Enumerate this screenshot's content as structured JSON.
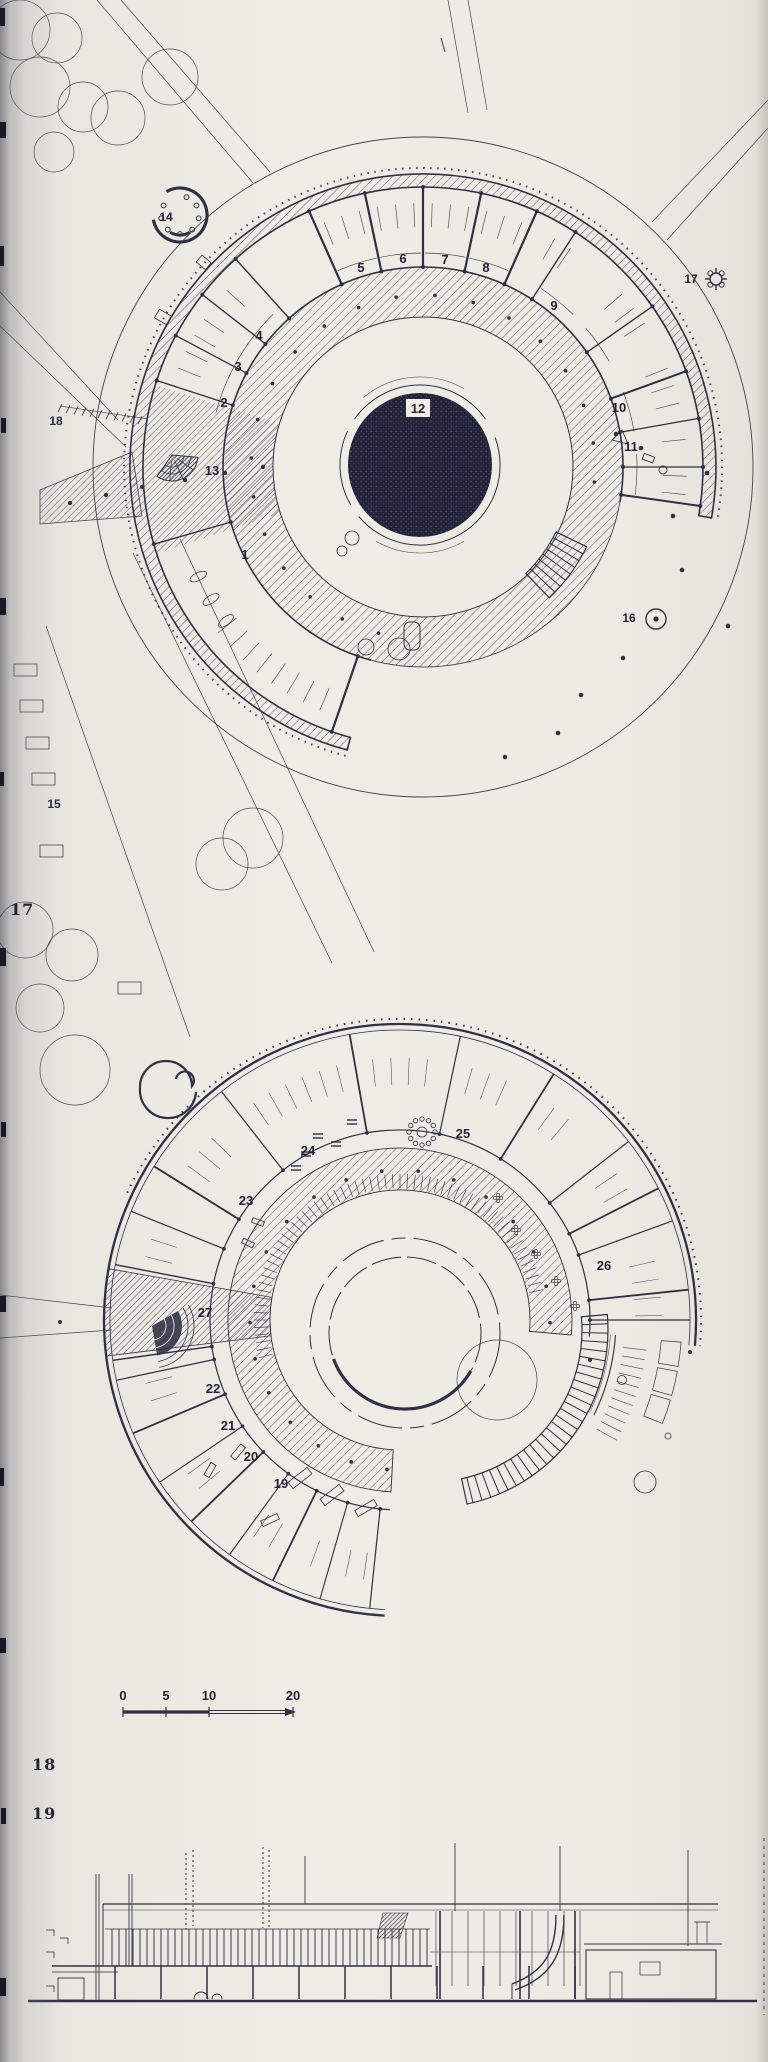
{
  "page": {
    "kind": "scanned architectural drawing page",
    "paper_color": "#ece9e2",
    "ink_color": "#2f3046",
    "pond_fill": "#23233a"
  },
  "figure_margin_numbers": [
    {
      "label": "17",
      "x": 10,
      "y": 900
    },
    {
      "label": "18",
      "x": 32,
      "y": 1755
    },
    {
      "label": "19",
      "x": 32,
      "y": 1804
    }
  ],
  "plan_upper": {
    "description": "circular building ground-floor site plan",
    "room_labels": [
      {
        "n": "1",
        "x": 245,
        "y": 559
      },
      {
        "n": "2",
        "x": 224,
        "y": 407
      },
      {
        "n": "3",
        "x": 238,
        "y": 371
      },
      {
        "n": "4",
        "x": 259,
        "y": 340
      },
      {
        "n": "5",
        "x": 361,
        "y": 272
      },
      {
        "n": "6",
        "x": 403,
        "y": 263
      },
      {
        "n": "7",
        "x": 445,
        "y": 264
      },
      {
        "n": "8",
        "x": 486,
        "y": 272
      },
      {
        "n": "9",
        "x": 554,
        "y": 310
      },
      {
        "n": "10",
        "x": 619,
        "y": 412
      },
      {
        "n": "11",
        "x": 631,
        "y": 451
      },
      {
        "n": "13",
        "x": 212,
        "y": 475
      }
    ],
    "pond_label": {
      "n": "12",
      "x": 418,
      "y": 413
    },
    "site_labels": [
      {
        "n": "14",
        "x": 166,
        "y": 221
      },
      {
        "n": "15",
        "x": 54,
        "y": 808
      },
      {
        "n": "16",
        "x": 629,
        "y": 622
      },
      {
        "n": "17",
        "x": 691,
        "y": 283
      },
      {
        "n": "18",
        "x": 56,
        "y": 425
      }
    ]
  },
  "plan_lower": {
    "description": "circular building floor plan, C-shaped level",
    "room_labels": [
      {
        "n": "19",
        "x": 281,
        "y": 1488
      },
      {
        "n": "20",
        "x": 251,
        "y": 1461
      },
      {
        "n": "21",
        "x": 228,
        "y": 1430
      },
      {
        "n": "22",
        "x": 213,
        "y": 1393
      },
      {
        "n": "23",
        "x": 246,
        "y": 1205
      },
      {
        "n": "24",
        "x": 308,
        "y": 1155
      },
      {
        "n": "25",
        "x": 463,
        "y": 1138
      },
      {
        "n": "26",
        "x": 604,
        "y": 1270
      },
      {
        "n": "27",
        "x": 205,
        "y": 1317
      }
    ]
  },
  "scale_bar": {
    "labels": [
      {
        "text": "0",
        "x": 123
      },
      {
        "text": "5",
        "x": 166
      },
      {
        "text": "10",
        "x": 209
      },
      {
        "text": "20",
        "x": 293
      }
    ]
  }
}
